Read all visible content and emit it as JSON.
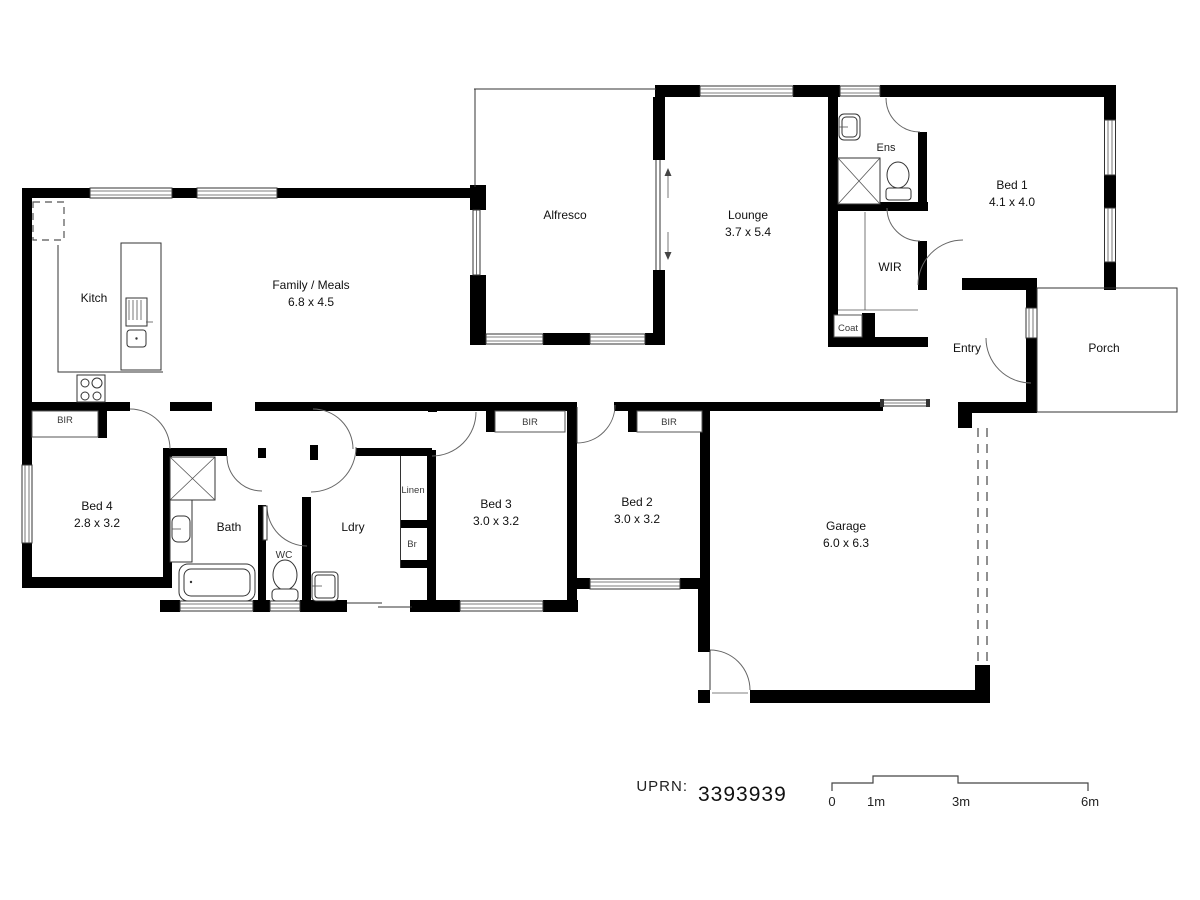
{
  "plan": {
    "rooms": {
      "kitch": {
        "label": "Kitch"
      },
      "family": {
        "label": "Family / Meals",
        "dims": "6.8 x 4.5"
      },
      "alfresco": {
        "label": "Alfresco"
      },
      "lounge": {
        "label": "Lounge",
        "dims": "3.7 x 5.4"
      },
      "ens": {
        "label": "Ens"
      },
      "wir": {
        "label": "WIR"
      },
      "bed1": {
        "label": "Bed 1",
        "dims": "4.1 x 4.0"
      },
      "coat": {
        "label": "Coat"
      },
      "entry": {
        "label": "Entry"
      },
      "porch": {
        "label": "Porch"
      },
      "bed4": {
        "label": "Bed 4",
        "dims": "2.8 x 3.2"
      },
      "bath": {
        "label": "Bath"
      },
      "wc": {
        "label": "WC"
      },
      "ldry": {
        "label": "Ldry"
      },
      "linen": {
        "label": "Linen"
      },
      "br": {
        "label": "Br"
      },
      "bed3": {
        "label": "Bed 3",
        "dims": "3.0 x 3.2"
      },
      "bed2": {
        "label": "Bed 2",
        "dims": "3.0 x 3.2"
      },
      "garage": {
        "label": "Garage",
        "dims": "6.0 x 6.3"
      },
      "bir": {
        "label": "BIR"
      }
    },
    "footer": {
      "uprn_label": "UPRN:",
      "uprn_value": "3393939"
    },
    "scale": {
      "ticks": [
        "0",
        "1m",
        "3m",
        "6m"
      ]
    },
    "colors": {
      "wall": "#000000",
      "line": "#444444",
      "background": "#ffffff"
    }
  }
}
